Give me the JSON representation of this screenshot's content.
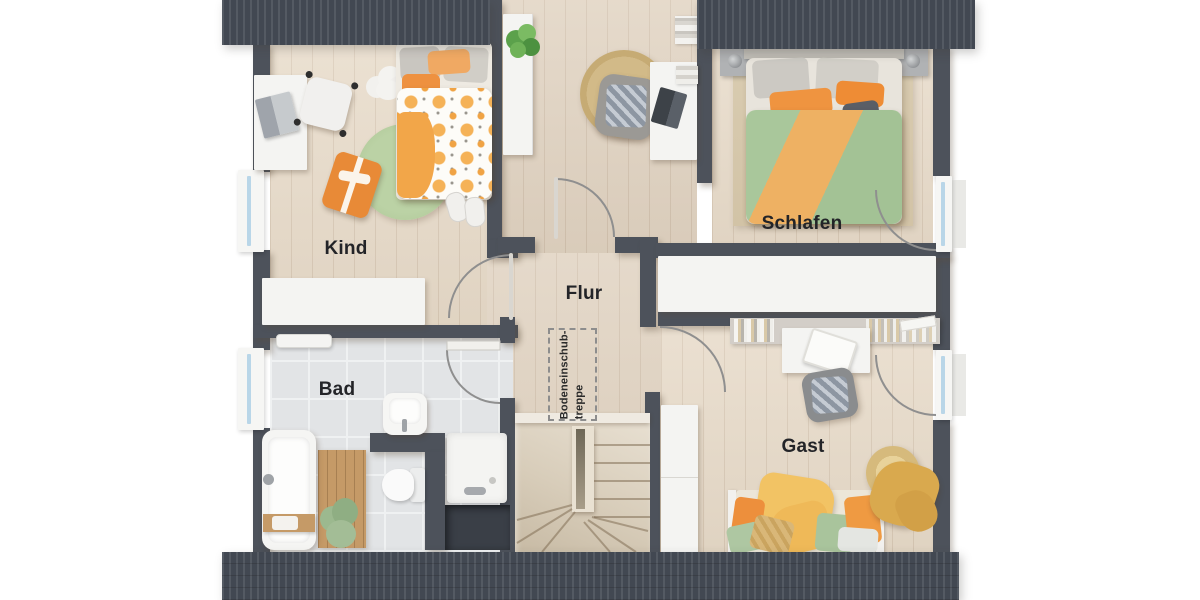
{
  "floorplan": {
    "title": "Dachgeschoss-Grundriss",
    "rooms": [
      {
        "id": "kind",
        "label": "Kind"
      },
      {
        "id": "schlafen",
        "label": "Schlafen"
      },
      {
        "id": "flur",
        "label": "Flur"
      },
      {
        "id": "bad",
        "label": "Bad"
      },
      {
        "id": "gast",
        "label": "Gast"
      }
    ],
    "annotations": [
      {
        "id": "attic-hatch",
        "text": "Bodeneinschub-\ntreppe"
      }
    ],
    "colors": {
      "wall": "#4d525b",
      "roof": "#464c56",
      "wood_floor": "#e7dac8",
      "hall_floor": "#e0d2c0",
      "bath_tiles": "#e2e4e6",
      "accent_orange": "#ee9140",
      "accent_green": "#aec7a0",
      "accent_yellow": "#f2c364",
      "window_glass": "#b9d6e8",
      "furniture_white": "#f4f4f2"
    }
  }
}
